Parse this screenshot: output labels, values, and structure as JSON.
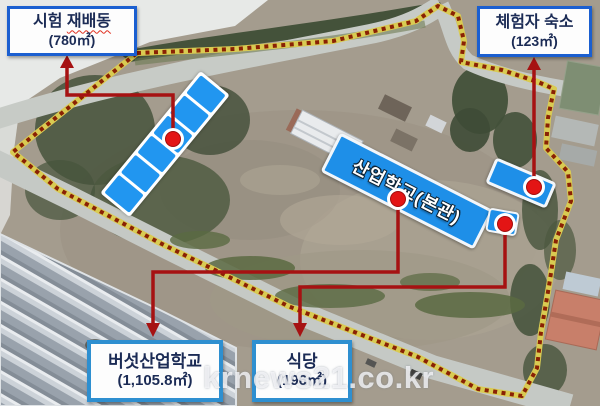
{
  "annotations": {
    "boxes": {
      "test_cultivation": {
        "title_prefix": "시험 ",
        "title_underlined": "재배동",
        "area": "(780㎡)"
      },
      "lodging": {
        "title": "체험자 숙소",
        "area": "(123㎡)"
      },
      "mushroom_school": {
        "title": "버섯산업학교",
        "area": "(1,105.8㎡)"
      },
      "cafeteria": {
        "title": "식당",
        "area": "(196㎡)"
      }
    },
    "map_label": {
      "title": "산업학교(본관)"
    }
  },
  "watermark": "krnews21.co.kr",
  "colors": {
    "building_highlight_blue": "#1e8fe8",
    "callout_border_top": "#1b5fd0",
    "callout_border_bottom": "#2e8fd0",
    "boundary_yellow": "#d9cb52",
    "boundary_dot_red": "#8a2104",
    "connector_red": "#a61212",
    "marker_red": "#e31515"
  }
}
